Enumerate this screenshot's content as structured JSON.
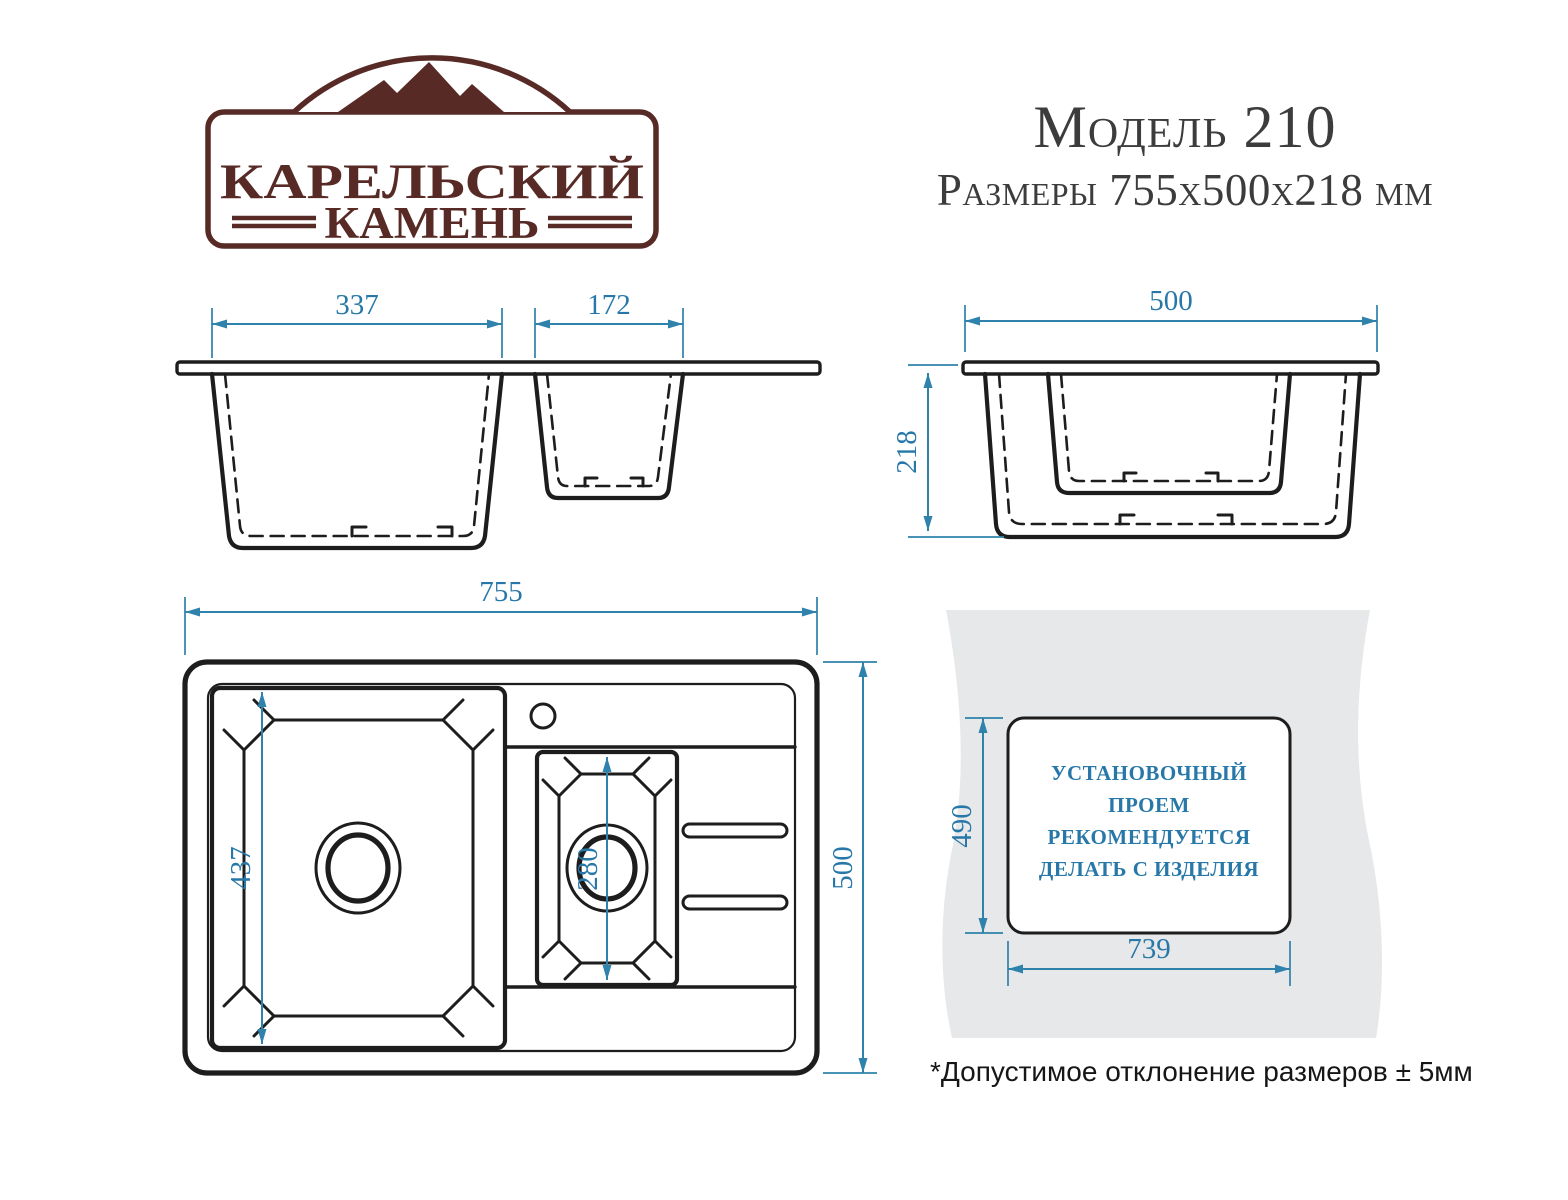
{
  "header": {
    "model": "Модель 210",
    "dimensions": "Размеры 755x500x218 мм"
  },
  "logo": {
    "line1": "КАРЕЛЬСКИЙ",
    "line2": "КАМЕНЬ"
  },
  "views": {
    "front": {
      "bowl1_width": "337",
      "bowl2_width": "172"
    },
    "side": {
      "width": "500",
      "height": "218"
    },
    "plan": {
      "width": "755",
      "depth": "500",
      "bowl1_length": "437",
      "bowl2_length": "280"
    }
  },
  "install": {
    "lines": [
      "УСТАНОВОЧНЫЙ",
      "ПРОЕМ",
      "РЕКОМЕНДУЕТСЯ",
      "ДЕЛАТЬ С ИЗДЕЛИЯ"
    ],
    "height": "490",
    "width": "739"
  },
  "note": "*Допустимое отклонение размеров ± 5мм",
  "colors": {
    "accent_maroon": "#572a26",
    "dimension_blue": "#2e82ab",
    "install_text_blue": "#2778a8",
    "panel_gray": "#e7e8e9",
    "line_black": "#1d1d1d"
  }
}
